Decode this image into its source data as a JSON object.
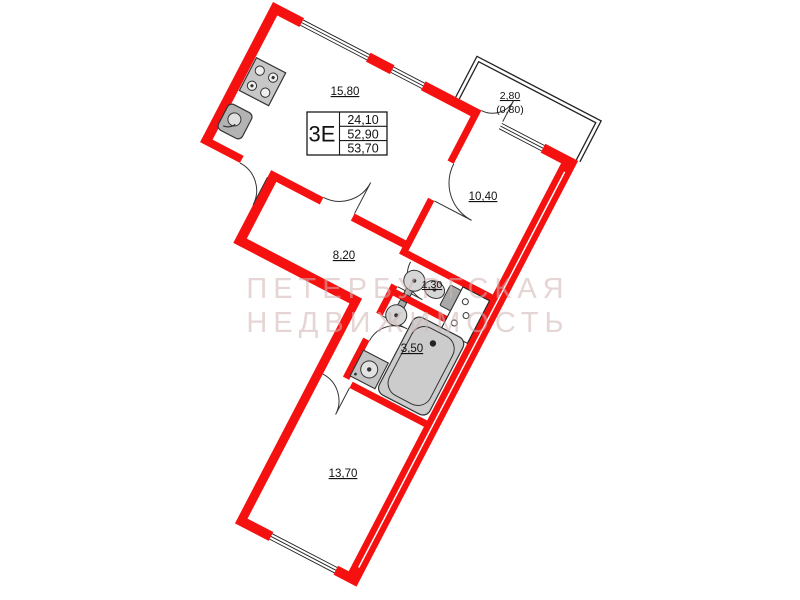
{
  "apartment": {
    "title_block": {
      "type": "3Е",
      "rows": [
        "24,10",
        "52,90",
        "53,70"
      ]
    },
    "rooms": [
      {
        "id": "kitchen-living",
        "area": "15,80"
      },
      {
        "id": "balcony",
        "area": "2,80",
        "area_coeff": "(0,80)"
      },
      {
        "id": "room-right",
        "area": "10,40"
      },
      {
        "id": "hallway",
        "area": "8,20"
      },
      {
        "id": "wc",
        "area": "1,30"
      },
      {
        "id": "bathroom",
        "area": "3,50"
      },
      {
        "id": "room-bottom",
        "area": "13,70"
      }
    ],
    "watermark": [
      "ПЕТЕРБУРГСКАЯ",
      "НЕДВИЖИМОСТЬ"
    ],
    "colors": {
      "wall": "#f61111",
      "outline": "#222222",
      "door_line": "#333333",
      "fixture_fill": "#cccccc",
      "text": "#111111"
    }
  }
}
